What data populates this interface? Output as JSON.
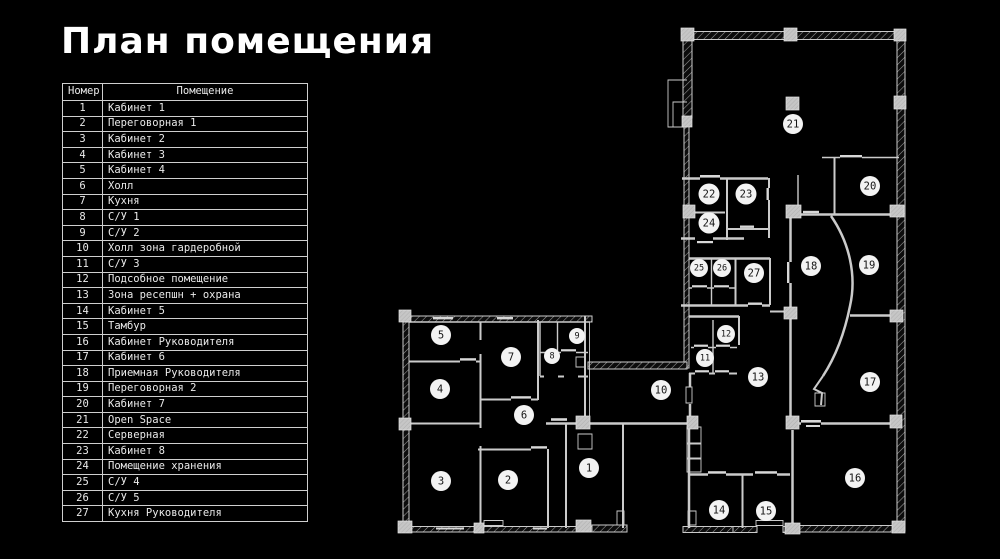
{
  "title": "План помещения",
  "table": {
    "headers": [
      "Номер",
      "Помещение"
    ],
    "rows": [
      [
        "1",
        "Кабинет 1"
      ],
      [
        "2",
        "Переговорная 1"
      ],
      [
        "3",
        "Кабинет 2"
      ],
      [
        "4",
        "Кабинет 3"
      ],
      [
        "5",
        "Кабинет 4"
      ],
      [
        "6",
        "Холл"
      ],
      [
        "7",
        "Кухня"
      ],
      [
        "8",
        "С/У 1"
      ],
      [
        "9",
        "С/У 2"
      ],
      [
        "10",
        "Холл зона гардеробной"
      ],
      [
        "11",
        "С/У 3"
      ],
      [
        "12",
        "Подсобное помещение"
      ],
      [
        "13",
        "Зона ресепшн + охрана"
      ],
      [
        "14",
        "Кабинет 5"
      ],
      [
        "15",
        "Тамбур"
      ],
      [
        "16",
        "Кабинет Руководителя"
      ],
      [
        "17",
        "Кабинет 6"
      ],
      [
        "18",
        "Приемная Руководителя"
      ],
      [
        "19",
        "Переговорная 2"
      ],
      [
        "20",
        "Кабинет 7"
      ],
      [
        "21",
        "Open Space"
      ],
      [
        "22",
        "Серверная"
      ],
      [
        "23",
        "Кабинет 8"
      ],
      [
        "24",
        "Помещение хранения"
      ],
      [
        "25",
        "С/У 4"
      ],
      [
        "26",
        "С/У 5"
      ],
      [
        "27",
        "Кухня Руководителя"
      ]
    ]
  },
  "plan": {
    "colors": {
      "background": "#000000",
      "wall": "#cbcbcb",
      "label_fill": "#f3f3f3",
      "label_text": "#141414",
      "table_text": "#eaeaea"
    },
    "labels": [
      {
        "n": "1",
        "x": 589,
        "y": 468,
        "r": 10
      },
      {
        "n": "2",
        "x": 508,
        "y": 480,
        "r": 10
      },
      {
        "n": "3",
        "x": 441,
        "y": 481,
        "r": 10
      },
      {
        "n": "4",
        "x": 440,
        "y": 389,
        "r": 10
      },
      {
        "n": "5",
        "x": 441,
        "y": 335,
        "r": 10
      },
      {
        "n": "6",
        "x": 524,
        "y": 415,
        "r": 10
      },
      {
        "n": "7",
        "x": 511,
        "y": 357,
        "r": 10
      },
      {
        "n": "8",
        "x": 552,
        "y": 356,
        "r": 8
      },
      {
        "n": "9",
        "x": 577,
        "y": 336,
        "r": 8
      },
      {
        "n": "10",
        "x": 661,
        "y": 390,
        "r": 10
      },
      {
        "n": "11",
        "x": 705,
        "y": 358,
        "r": 9
      },
      {
        "n": "12",
        "x": 726,
        "y": 334,
        "r": 9
      },
      {
        "n": "13",
        "x": 758,
        "y": 377,
        "r": 10
      },
      {
        "n": "14",
        "x": 719,
        "y": 510,
        "r": 10
      },
      {
        "n": "15",
        "x": 766,
        "y": 511,
        "r": 10
      },
      {
        "n": "16",
        "x": 855,
        "y": 478,
        "r": 10
      },
      {
        "n": "17",
        "x": 870,
        "y": 382,
        "r": 10
      },
      {
        "n": "18",
        "x": 811,
        "y": 266,
        "r": 10
      },
      {
        "n": "19",
        "x": 869,
        "y": 265,
        "r": 10
      },
      {
        "n": "20",
        "x": 870,
        "y": 186,
        "r": 10
      },
      {
        "n": "21",
        "x": 793,
        "y": 124,
        "r": 10
      },
      {
        "n": "22",
        "x": 709,
        "y": 194,
        "r": 10.5
      },
      {
        "n": "23",
        "x": 746,
        "y": 194,
        "r": 10.5
      },
      {
        "n": "24",
        "x": 709,
        "y": 223,
        "r": 10.5
      },
      {
        "n": "25",
        "x": 699,
        "y": 268,
        "r": 9
      },
      {
        "n": "26",
        "x": 722,
        "y": 268,
        "r": 9
      },
      {
        "n": "27",
        "x": 754,
        "y": 273,
        "r": 10
      }
    ]
  }
}
